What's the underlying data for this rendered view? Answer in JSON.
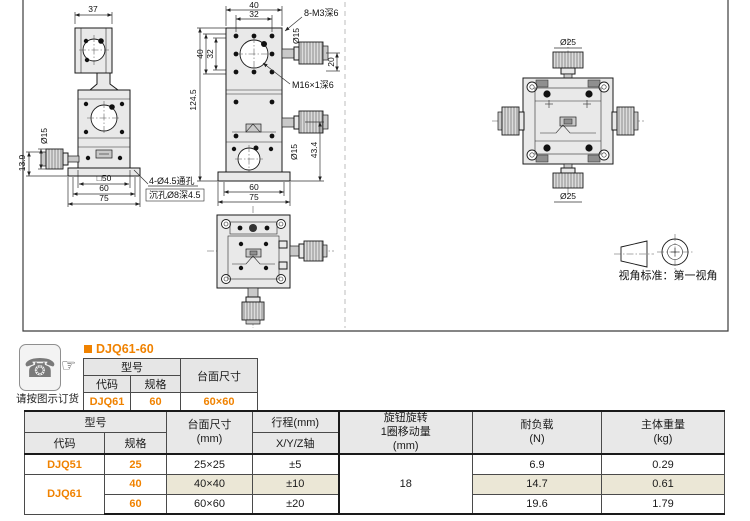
{
  "drawings": {
    "side_view": {
      "dim_width_top": "37",
      "dim_knob_dia": "Ø15",
      "dim_knob_height": "13.9",
      "dim_square": "□50",
      "dim_base_inner": "60",
      "dim_base_outer": "75",
      "callout_holes_line1": "4-Ø4.5通孔",
      "callout_holes_line2": "沉孔Ø8深4.5"
    },
    "front_view": {
      "dim_top_width": "40",
      "dim_top_inner": "32",
      "callout_corner_tap": "8-M3深6",
      "dim_knob_dia_top": "Ø15",
      "dim_knob_offset": "20",
      "callout_center_tap": "M16×1深6",
      "dim_height": "124.5",
      "dim_side_40": "40",
      "dim_side_32": "32",
      "dim_knob_dia_mid": "Ø15",
      "dim_knob_height": "43.4",
      "dim_base_inner": "60",
      "dim_base_outer": "75"
    },
    "plan_view": {
      "dim_knob_top": "Ø25",
      "dim_knob_bottom": "Ø25"
    },
    "view_standard": {
      "label": "视角标准：第一视角"
    }
  },
  "ordering": {
    "phone_icon": "☎",
    "finger_icon": "☞",
    "note": "请按图示订货",
    "title": "DJQ61-60",
    "table": {
      "header_model": "型号",
      "header_code": "代码",
      "header_spec": "规格",
      "header_surface": "台面尺寸",
      "code": "DJQ61",
      "spec": "60",
      "surface": "60×60"
    }
  },
  "spec_table": {
    "header_model": "型号",
    "header_code": "代码",
    "header_spec": "规格",
    "header_surface_l1": "台面尺寸",
    "header_surface_l2": "(mm)",
    "header_travel": "行程(mm)",
    "header_travel_axis": "X/Y/Z轴",
    "header_knob_l1": "旋钮旋转",
    "header_knob_l2": "1圈移动量",
    "header_knob_l3": "(mm)",
    "header_load_l1": "耐负载",
    "header_load_l2": "(N)",
    "header_weight_l1": "主体重量",
    "header_weight_l2": "(kg)",
    "knob_travel_per_turn": "18",
    "rows": [
      {
        "code": "DJQ51",
        "spec": "25",
        "surface": "25×25",
        "travel": "±5",
        "load": "6.9",
        "weight": "0.29",
        "highlight": false
      },
      {
        "code": "DJQ61",
        "spec": "40",
        "surface": "40×40",
        "travel": "±10",
        "load": "14.7",
        "weight": "0.61",
        "highlight": true
      },
      {
        "code": "",
        "spec": "60",
        "surface": "60×60",
        "travel": "±20",
        "load": "19.6",
        "weight": "1.79",
        "highlight": false
      }
    ]
  },
  "colors": {
    "accent_orange": "#f08200",
    "highlight_beige": "#ebe7d6",
    "header_gray": "#e8e8e8"
  }
}
